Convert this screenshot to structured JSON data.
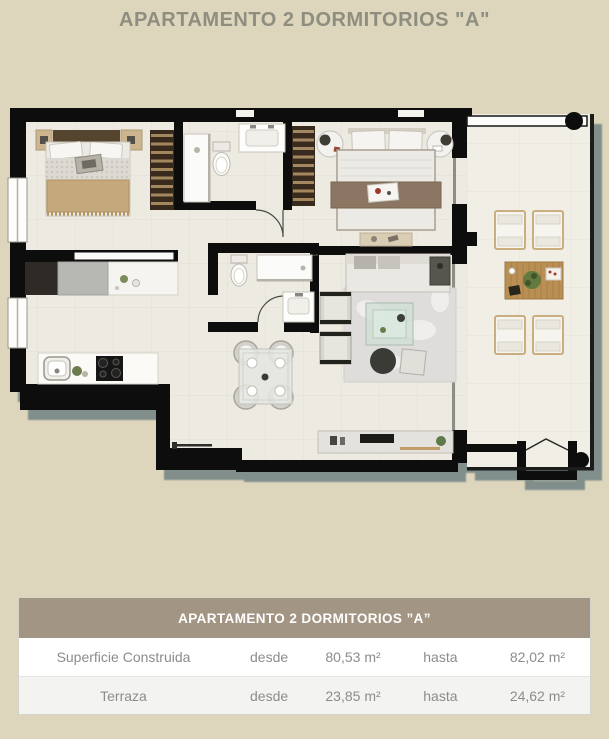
{
  "page": {
    "title": "APARTAMENTO 2 DORMITORIOS \"A\""
  },
  "floorplan": {
    "rooms": [
      "bedroom-1",
      "bathroom-1",
      "bedroom-2",
      "bathroom-2",
      "kitchen",
      "dining-area",
      "living-room",
      "entry-hall",
      "terrace"
    ],
    "furniture": [
      "double-bed",
      "wardrobe",
      "shower",
      "toilet",
      "vanity-sink",
      "double-bed-2",
      "nightstands",
      "kitchen-counter",
      "sink",
      "cooktop",
      "dining-table-4-chairs",
      "sofa",
      "armchairs",
      "coffee-table",
      "rug",
      "tv-console",
      "lounge-chairs",
      "terrace-table",
      "entrance-door",
      "railing",
      "column"
    ]
  },
  "table": {
    "header": "APARTAMENTO 2 DORMITORIOS ”A”",
    "rows": [
      {
        "label": "Superficie Construida",
        "from_label": "desde",
        "from_value": "80,53 m²",
        "to_label": "hasta",
        "to_value": "82,02 m²"
      },
      {
        "label": "Terraza",
        "from_label": "desde",
        "from_value": "23,85 m²",
        "to_label": "hasta",
        "to_value": "24,62 m²"
      }
    ]
  },
  "colors": {
    "page_bg": "#ddd5bc",
    "title_text": "#8e8e80",
    "wall": "#0e0e0c",
    "floor": "#edeae2",
    "terrace_floor": "#f1eee6",
    "plan_shadow": "#7b8b88",
    "table_header_bg": "#a39583",
    "table_header_text": "#ffffff",
    "table_row_text": "#8c8c8c",
    "table_row_alt_bg": "#f3f3f1",
    "table_bg": "#ffffff",
    "table_border": "#d6d3ca"
  }
}
